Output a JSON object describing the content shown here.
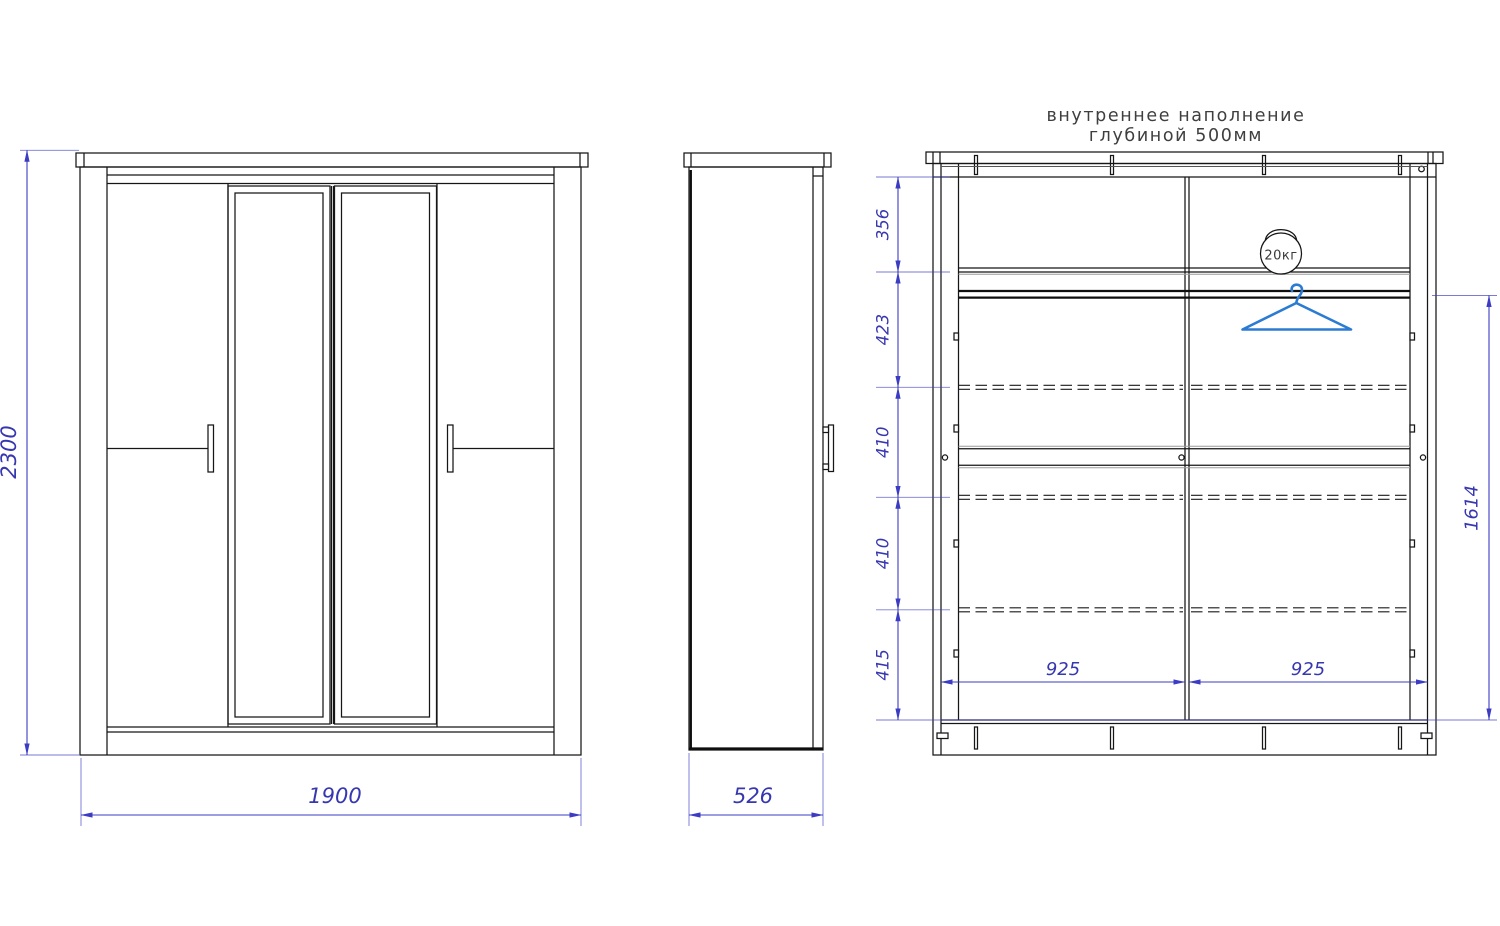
{
  "title": {
    "line1": "внутреннее наполнение",
    "line2": "глубиной 500мм"
  },
  "views": {
    "front": {
      "height_mm": "2300",
      "width_mm": "1900"
    },
    "side": {
      "depth_mm": "526"
    },
    "internal": {
      "sections": [
        {
          "label": "356"
        },
        {
          "label": "423"
        },
        {
          "label": "410"
        },
        {
          "label": "410"
        },
        {
          "label": "415"
        }
      ],
      "rod_to_bottom_mm": "1614",
      "compartments": [
        {
          "width_mm": "925"
        },
        {
          "width_mm": "925"
        }
      ],
      "max_load": "20кг"
    }
  },
  "colors": {
    "dimension_blue": "#3b3bc4",
    "dimension_text_blue": "#3737b0",
    "line_black": "#161616",
    "shading_gray": "#9b9b9b",
    "hanger_blue": "#2b7bd3",
    "title_gray": "#3f3f3f"
  }
}
